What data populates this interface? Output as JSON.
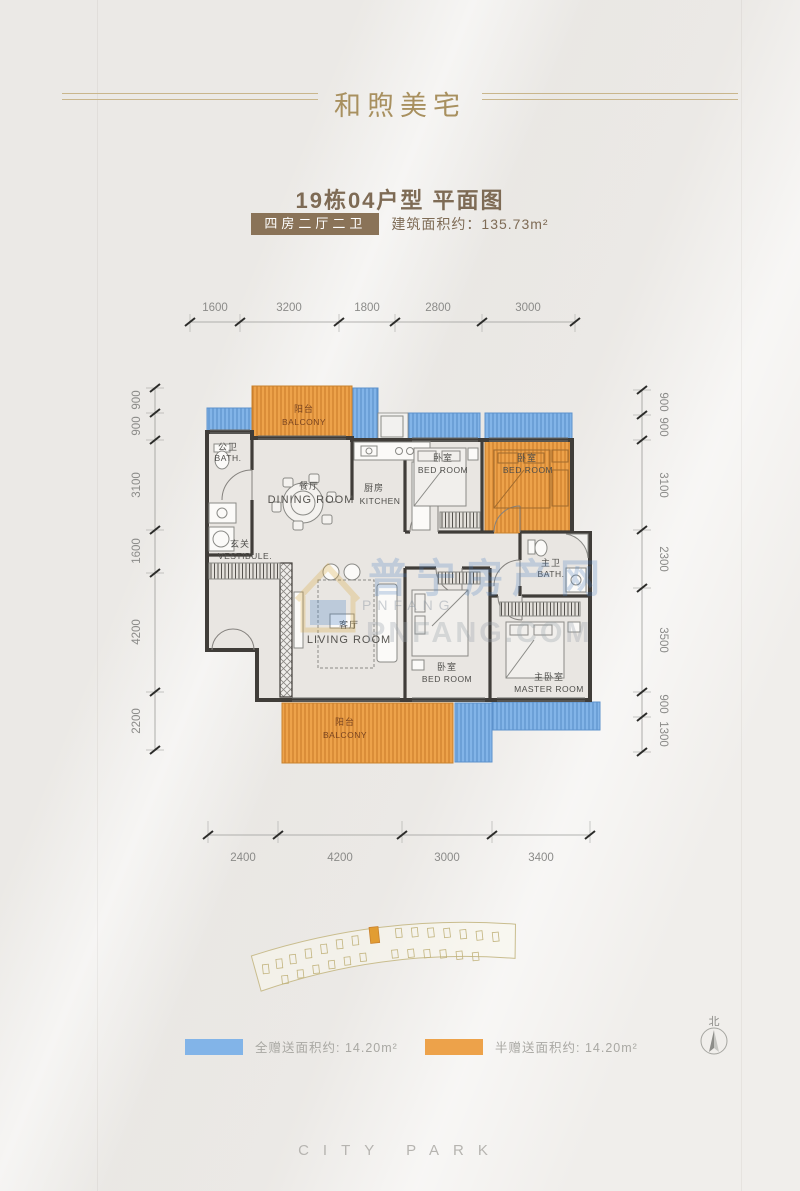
{
  "header": {
    "title": "和煦美宅"
  },
  "plan_info": {
    "subtitle": "19栋04户型 平面图",
    "layout_badge": "四房二厅二卫",
    "area_label": "建筑面积约：135.73m²"
  },
  "floorplan": {
    "dimensions": {
      "top": [
        "1600",
        "3200",
        "1800",
        "2800",
        "3000"
      ],
      "bottom": [
        "2400",
        "4200",
        "3000",
        "3400"
      ],
      "left": [
        "900",
        "900",
        "3100",
        "1600",
        "4200",
        "2200"
      ],
      "right": [
        "900",
        "900",
        "3100",
        "2300",
        "3500",
        "900",
        "1300"
      ]
    },
    "rooms": {
      "bath_public": {
        "cn": "公卫",
        "en": "BATH."
      },
      "balcony_top": {
        "cn": "阳台",
        "en": "BALCONY"
      },
      "dining": {
        "cn": "餐厅",
        "en": "DINING ROOM"
      },
      "kitchen": {
        "cn": "厨房",
        "en": "KITCHEN"
      },
      "bedroom_top_left": {
        "cn": "卧室",
        "en": "BED ROOM"
      },
      "bedroom_top_right": {
        "cn": "卧室",
        "en": "BED ROOM"
      },
      "vestibule": {
        "cn": "玄关",
        "en": "VESTIBULE."
      },
      "living": {
        "cn": "客厅",
        "en": "LIVING ROOM"
      },
      "bedroom_bottom": {
        "cn": "卧室",
        "en": "BED ROOM"
      },
      "bath_master": {
        "cn": "主卫",
        "en": "BATH."
      },
      "master": {
        "cn": "主卧室",
        "en": "MASTER ROOM"
      },
      "balcony_bottom": {
        "cn": "阳台",
        "en": "BALCONY"
      }
    }
  },
  "legend": {
    "full_gift": {
      "label": "全赠送面积约: 14.20m²",
      "color": "#82b4e8"
    },
    "half_gift": {
      "label": "半赠送面积约: 14.20m²",
      "color": "#eda24a"
    }
  },
  "watermark": {
    "cn": "普宁房产网",
    "small": "PNFANG",
    "site": "PNFANG.COM"
  },
  "compass": {
    "north_label": "北"
  },
  "footer": {
    "brand": "CITY PARK"
  },
  "colors": {
    "accent_gold": "#a8905f",
    "badge_brown": "#8a7358",
    "gift_blue": "#82b4e8",
    "gift_orange": "#eda24a",
    "wall": "#403d39"
  }
}
